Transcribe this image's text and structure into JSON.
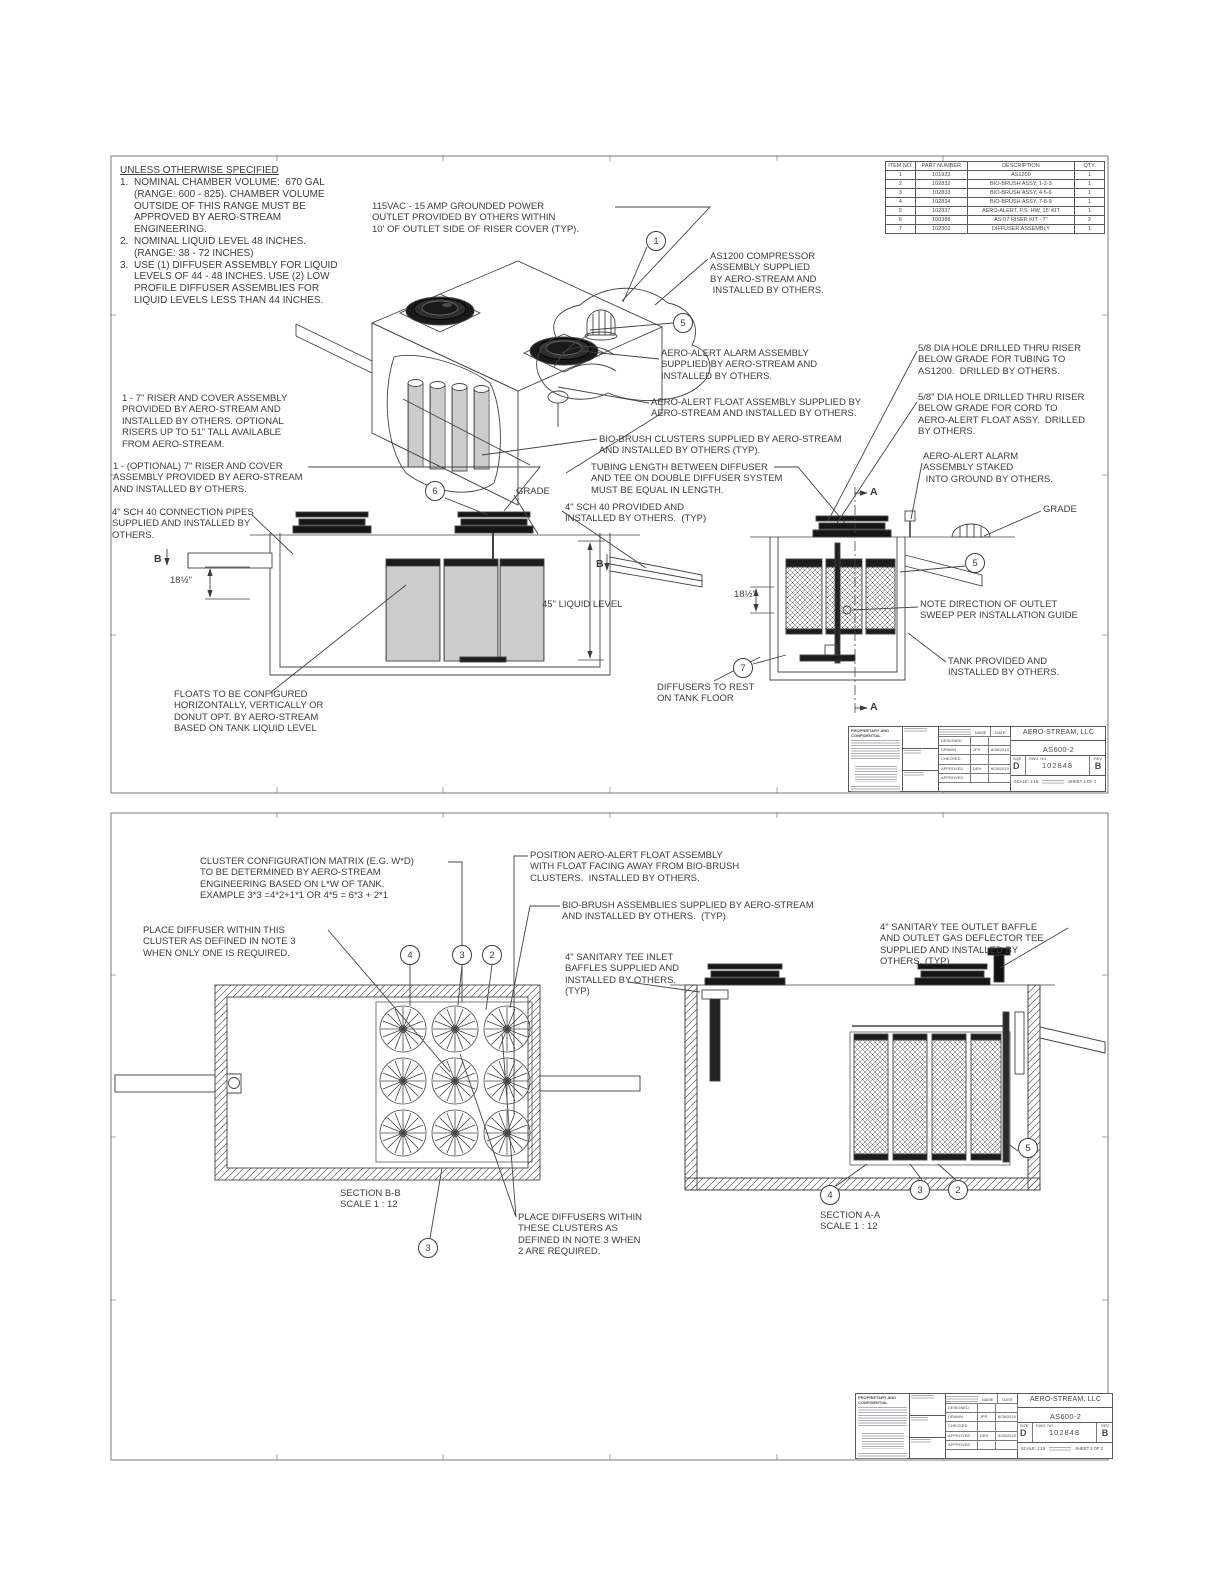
{
  "titleblock": {
    "proprietary": "PROPRIETARY AND CONFIDENTIAL",
    "name_h": "NAME",
    "date_h": "DATE",
    "rows": [
      "DESIGNED",
      "DRAWN",
      "CHECKED",
      "APPROVED",
      "APPROVED"
    ],
    "drawn_name": "JPS",
    "drawn_date": "8/28/2019",
    "approved_name": "DEH",
    "approved_date": "8/28/2019",
    "company": "AERO-STREAM, LLC",
    "title": "AS600-2",
    "size_label": "SIZE",
    "size": "D",
    "dwg_label": "DWG. NO.",
    "dwg_no": "102848",
    "rev_label": "REV",
    "rev": "B",
    "scale": "SCALE: 1:16",
    "sheet1": "SHEET 1 OF 2",
    "sheet2": "SHEET 2 OF 2"
  },
  "sheet1": {
    "notes": {
      "title": "UNLESS OTHERWISE SPECIFIED",
      "items": [
        {
          "num": "1.",
          "text": "NOMINAL CHAMBER VOLUME:  670 GAL\n(RANGE: 600 - 825). CHAMBER VOLUME\nOUTSIDE OF THIS RANGE MUST BE\nAPPROVED BY AERO-STREAM\nENGINEERING."
        },
        {
          "num": "2.",
          "text": "NOMINAL LIQUID LEVEL 48 INCHES.\n(RANGE: 38 - 72 INCHES)"
        },
        {
          "num": "3.",
          "text": "USE (1) DIFFUSER ASSEMBLY FOR LIQUID\nLEVELS OF 44 - 48 INCHES. USE (2) LOW\nPROFILE DIFFUSER ASSEMBLIES FOR\nLIQUID LEVELS LESS THAN 44 INCHES."
        }
      ]
    },
    "parts": {
      "headers": [
        "ITEM NO.",
        "PART NUMBER",
        "DESCRIPTION",
        "QTY."
      ],
      "rows": [
        [
          "1",
          "101923",
          "AS1200",
          "1"
        ],
        [
          "2",
          "102832",
          "BIO-BRUSH ASSY, 1-2-3",
          "1"
        ],
        [
          "3",
          "102833",
          "BIO-BRUSH ASSY, 4-5-6",
          "1"
        ],
        [
          "4",
          "102834",
          "BIO-BRUSH ASSY, 7-8-9",
          "1"
        ],
        [
          "5",
          "102837",
          "AERO-ALERT, P.S. HW, 15' KIT",
          "1"
        ],
        [
          "6",
          "100388",
          "AS-07 RISER KIT - 7\"",
          "2"
        ],
        [
          "7",
          "102302",
          "DIFFUSER ASSEMBLY",
          "1"
        ]
      ]
    },
    "callouts": {
      "power": "115VAC - 15 AMP GROUNDED POWER\nOUTLET PROVIDED BY OTHERS WITHIN\n10' OF OUTLET SIDE OF RISER COVER (TYP).",
      "compressor": "AS1200 COMPRESSOR\nASSEMBLY SUPPLIED\nBY AERO-STREAM AND\n INSTALLED BY OTHERS.",
      "alarm": "AERO-ALERT ALARM ASSEMBLY\nSUPPLIED BY AERO-STREAM AND\nINSTALLED BY OTHERS.",
      "float": "AERO-ALERT FLOAT ASSEMBLY SUPPLIED BY\nAERO-STREAM AND INSTALLED BY OTHERS.",
      "biobrush": "BIO-BRUSH CLUSTERS SUPPLIED BY AERO-STREAM\nAND INSTALLED BY OTHERS (TYP).",
      "tubing": "TUBING LENGTH BETWEEN DIFFUSER\nAND TEE ON DOUBLE DIFFUSER SYSTEM\nMUST BE EQUAL IN LENGTH.",
      "riser1": "1 - 7\" RISER AND COVER ASSEMBLY\nPROVIDED BY AERO-STREAM AND\nINSTALLED BY OTHERS. OPTIONAL\nRISERS UP TO 51\" TALL AVAILABLE\nFROM AERO-STREAM.",
      "riser2": "1 - (OPTIONAL) 7\" RISER AND COVER\nASSEMBLY PROVIDED BY AERO-STREAM\nAND INSTALLED BY OTHERS.",
      "pipes": "4\" SCH 40 CONNECTION PIPES\nSUPPLIED AND INSTALLED BY\nOTHERS.",
      "sch40": "4\" SCH 40 PROVIDED AND\nINSTALLED BY OTHERS.  (TYP)",
      "grade_left": "GRADE",
      "grade_right": "GRADE",
      "hole_tubing": "5/8 DIA HOLE DRILLED THRU RISER\nBELOW GRADE FOR TUBING TO\nAS1200.  DRILLED BY OTHERS.",
      "hole_cord": "5/8\" DIA HOLE DRILLED THRU RISER\nBELOW GRADE FOR CORD TO\nAERO-ALERT FLOAT ASSY.  DRILLED\nBY OTHERS.",
      "staked": "AERO-ALERT ALARM\nASSEMBLY STAKED\n INTO GROUND BY OTHERS.",
      "floats": "FLOATS TO BE CONFIGURED\nHORIZONTALLY, VERTICALLY OR\nDONUT OPT. BY AERO-STREAM\nBASED ON TANK LIQUID LEVEL",
      "diffusers_rest": "DIFFUSERS TO REST\nON TANK FLOOR",
      "sweep": "NOTE DIRECTION OF OUTLET\nSWEEP PER INSTALLATION GUIDE",
      "tank": "TANK PROVIDED AND\nINSTALLED BY OTHERS."
    },
    "dims": {
      "d18_left": "18½\"",
      "d18_right": "18½\"",
      "liquid": "45\" LIQUID LEVEL"
    },
    "letters": {
      "a": "A",
      "b": "B"
    },
    "balloons": {
      "b1": "1",
      "b5a": "5",
      "b6": "6",
      "b7": "7",
      "b5b": "5"
    }
  },
  "sheet2": {
    "callouts": {
      "matrix": "CLUSTER CONFIGURATION MATRIX (E.G. W*D)\nTO BE DETERMINED BY AERO-STREAM\nENGINEERING BASED ON L*W OF TANK.\nEXAMPLE 3*3 =4*2+1*1 OR 4*5 = 6*3 + 2*1",
      "place1": "PLACE DIFFUSER WITHIN THIS\nCLUSTER AS DEFINED IN NOTE 3\nWHEN ONLY ONE IS REQUIRED.",
      "position": "POSITION AERO-ALERT FLOAT ASSEMBLY\nWITH FLOAT FACING AWAY FROM BIO-BRUSH\nCLUSTERS.  INSTALLED BY OTHERS.",
      "biobrush": "BIO-BRUSH ASSEMBLIES SUPPLIED BY AERO-STREAM\nAND INSTALLED BY OTHERS.  (TYP)",
      "inlet": "4\" SANITARY TEE INLET\nBAFFLES SUPPLIED AND\nINSTALLED BY OTHERS.\n(TYP)",
      "outlet": "4\" SANITARY TEE OUTLET BAFFLE\nAND OUTLET GAS DEFLECTOR TEE\nSUPPLIED AND INSTALLED BY\nOTHERS. (TYP)",
      "place2": "PLACE DIFFUSERS WITHIN\nTHESE CLUSTERS AS\nDEFINED IN NOTE 3 WHEN\n2 ARE REQUIRED."
    },
    "sections": {
      "bb": "SECTION B-B\nSCALE 1 : 12",
      "aa": "SECTION A-A\nSCALE 1 : 12"
    },
    "balloons": {
      "t4": "4",
      "t3": "3",
      "t2": "2",
      "b3": "3",
      "a4": "4",
      "a3": "3",
      "a2": "2",
      "a5": "5"
    }
  }
}
